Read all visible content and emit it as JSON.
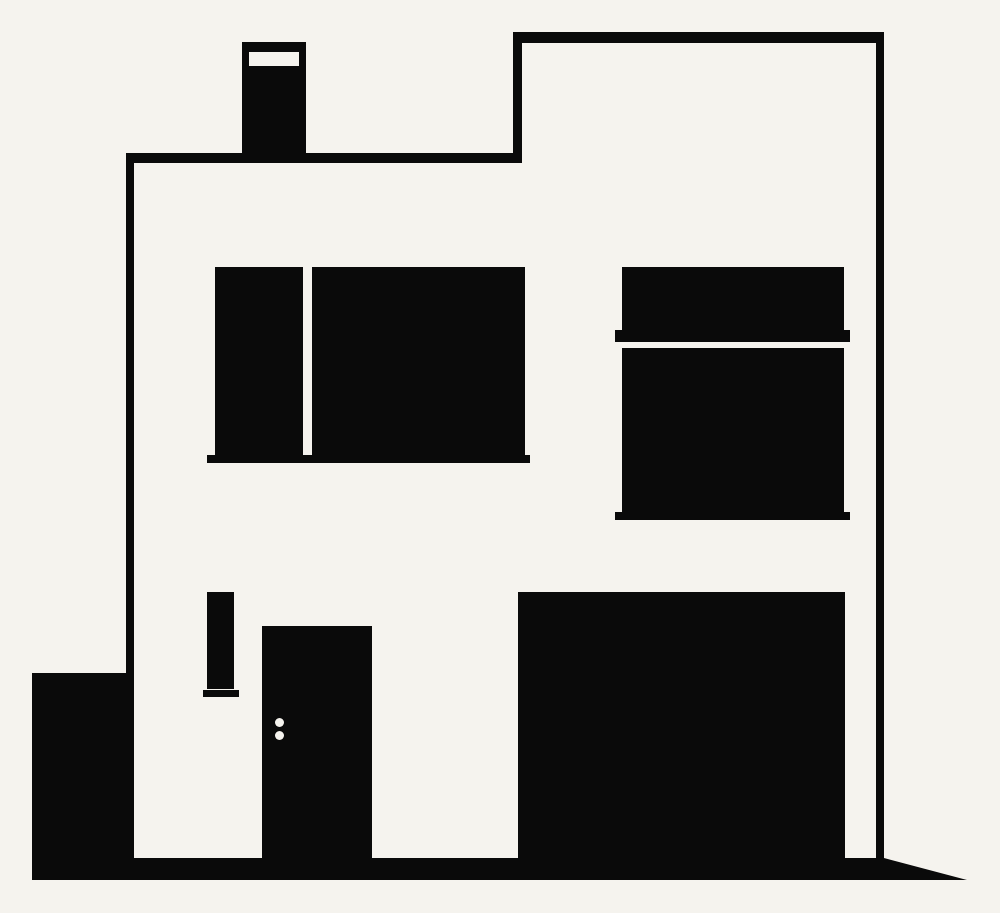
{
  "scene": {
    "description": "Minimalist flat black-and-white silhouette illustration of a modern two-storey house",
    "style": "flat vector silhouette",
    "background_color": "#f5f3ee",
    "ink_color": "#0a0a0a",
    "elements": {
      "chimney": "black chimney with white cap band on the lower left roof",
      "roof": "stepped flat roof, taller section on the right",
      "upper_left_window": "two black panes (narrow + wide) on a shared sill",
      "upper_right_window": "transom strip over main pane with mid and bottom sills",
      "slit_window": "narrow vertical slit window with small base, ground floor left",
      "door": "solid black front door with two white handle dots",
      "garage": "large solid black garage door on the right",
      "side_block": "low solid black side wall attached at lower left",
      "ground": "thick black ground line tapering to a point at the right"
    }
  }
}
